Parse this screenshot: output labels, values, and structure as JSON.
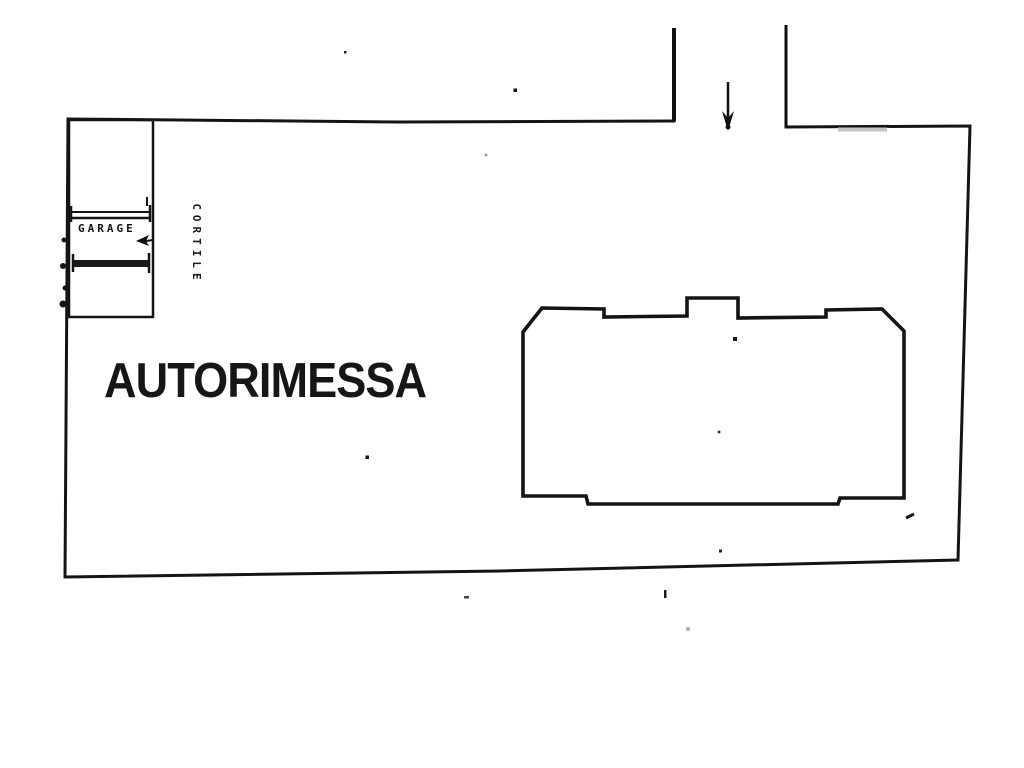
{
  "plan": {
    "labels": {
      "main_area": "AUTORIMESSA",
      "garage": "GARAGE",
      "courtyard": "CORTILE"
    },
    "icons": {
      "entrance_arrow": "down-arrow",
      "garage_arrow": "left-arrow"
    },
    "colors": {
      "ink": "#141414",
      "paper": "#ffffff",
      "faded_ink": "#bdbdbd"
    }
  }
}
